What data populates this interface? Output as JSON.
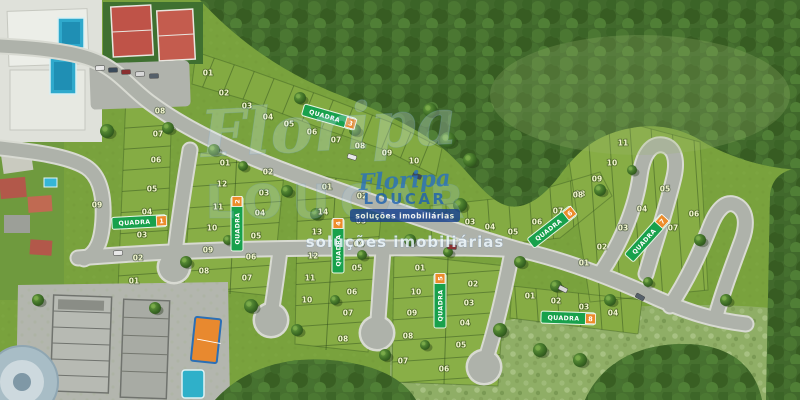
{
  "logo": {
    "name": "Floripa",
    "brand": "LOUCAR",
    "tagline": "soluções imobiliárias"
  },
  "watermark": {
    "script": "Floripa",
    "brand": "LOUCAR",
    "tagline": "soluções imobiliárias"
  },
  "quadra_label_text": "QUADRA",
  "quadras": [
    [
      "1",
      139,
      222,
      -3
    ],
    [
      "2",
      237,
      224,
      -90
    ],
    [
      "3",
      329,
      117,
      16
    ],
    [
      "4",
      338,
      246,
      -90
    ],
    [
      "5",
      440,
      301,
      -90
    ],
    [
      "6",
      552,
      227,
      -38
    ],
    [
      "7",
      647,
      238,
      -48
    ],
    [
      "8",
      568,
      318,
      2
    ]
  ],
  "lots": [
    [
      "01",
      208,
      73
    ],
    [
      "02",
      224,
      93
    ],
    [
      "03",
      247,
      106
    ],
    [
      "04",
      268,
      117
    ],
    [
      "05",
      289,
      124
    ],
    [
      "06",
      312,
      132
    ],
    [
      "07",
      336,
      140
    ],
    [
      "08",
      360,
      146
    ],
    [
      "09",
      387,
      153
    ],
    [
      "10",
      414,
      161
    ],
    [
      "08",
      160,
      111
    ],
    [
      "07",
      158,
      134
    ],
    [
      "06",
      156,
      160
    ],
    [
      "05",
      152,
      189
    ],
    [
      "04",
      147,
      212
    ],
    [
      "03",
      142,
      235
    ],
    [
      "02",
      138,
      258
    ],
    [
      "01",
      134,
      281
    ],
    [
      "09",
      97,
      205
    ],
    [
      "01",
      225,
      163
    ],
    [
      "02",
      268,
      172
    ],
    [
      "12",
      222,
      184
    ],
    [
      "03",
      264,
      193
    ],
    [
      "11",
      218,
      207
    ],
    [
      "04",
      260,
      213
    ],
    [
      "10",
      212,
      228
    ],
    [
      "05",
      256,
      236
    ],
    [
      "09",
      208,
      250
    ],
    [
      "06",
      251,
      257
    ],
    [
      "08",
      204,
      271
    ],
    [
      "07",
      247,
      278
    ],
    [
      "01",
      327,
      187
    ],
    [
      "14",
      323,
      212
    ],
    [
      "13",
      317,
      232
    ],
    [
      "12",
      313,
      256
    ],
    [
      "11",
      310,
      278
    ],
    [
      "10",
      307,
      300
    ],
    [
      "02",
      362,
      196
    ],
    [
      "03",
      361,
      221
    ],
    [
      "04",
      359,
      244
    ],
    [
      "05",
      357,
      268
    ],
    [
      "06",
      352,
      292
    ],
    [
      "07",
      348,
      313
    ],
    [
      "08",
      343,
      339
    ],
    [
      "01",
      420,
      268
    ],
    [
      "10",
      416,
      292
    ],
    [
      "09",
      412,
      313
    ],
    [
      "08",
      408,
      336
    ],
    [
      "07",
      403,
      361
    ],
    [
      "02",
      473,
      284
    ],
    [
      "03",
      469,
      303
    ],
    [
      "04",
      465,
      323
    ],
    [
      "05",
      461,
      345
    ],
    [
      "06",
      444,
      369
    ],
    [
      "02",
      445,
      216
    ],
    [
      "03",
      470,
      222
    ],
    [
      "04",
      490,
      227
    ],
    [
      "05",
      513,
      232
    ],
    [
      "06",
      537,
      222
    ],
    [
      "07",
      558,
      211
    ],
    [
      "08",
      580,
      194
    ],
    [
      "11",
      623,
      143
    ],
    [
      "10",
      612,
      163
    ],
    [
      "09",
      597,
      179
    ],
    [
      "08",
      578,
      195
    ],
    [
      "05",
      665,
      189
    ],
    [
      "04",
      642,
      209
    ],
    [
      "03",
      623,
      228
    ],
    [
      "02",
      602,
      247
    ],
    [
      "01",
      584,
      263
    ],
    [
      "06",
      694,
      214
    ],
    [
      "07",
      673,
      228
    ],
    [
      "01",
      530,
      296
    ],
    [
      "02",
      556,
      301
    ],
    [
      "03",
      584,
      307
    ],
    [
      "04",
      613,
      313
    ]
  ],
  "features": {
    "trees": [
      [
        107,
        131,
        7
      ],
      [
        168,
        128,
        6
      ],
      [
        214,
        150,
        6
      ],
      [
        186,
        262,
        6
      ],
      [
        243,
        166,
        5
      ],
      [
        287,
        191,
        6
      ],
      [
        316,
        214,
        6
      ],
      [
        251,
        306,
        7
      ],
      [
        297,
        330,
        6
      ],
      [
        335,
        300,
        5
      ],
      [
        362,
        255,
        5
      ],
      [
        410,
        240,
        6
      ],
      [
        448,
        252,
        5
      ],
      [
        300,
        98,
        6
      ],
      [
        355,
        130,
        6
      ],
      [
        460,
        205,
        7
      ],
      [
        520,
        262,
        6
      ],
      [
        556,
        286,
        6
      ],
      [
        610,
        300,
        6
      ],
      [
        648,
        282,
        5
      ],
      [
        600,
        190,
        6
      ],
      [
        632,
        170,
        5
      ],
      [
        700,
        240,
        6
      ],
      [
        726,
        300,
        6
      ],
      [
        500,
        330,
        7
      ],
      [
        540,
        350,
        7
      ],
      [
        580,
        360,
        7
      ],
      [
        448,
        140,
        8
      ],
      [
        470,
        160,
        7
      ],
      [
        430,
        110,
        7
      ],
      [
        155,
        308,
        6
      ],
      [
        38,
        300,
        6
      ],
      [
        228,
        240,
        5
      ],
      [
        385,
        355,
        6
      ],
      [
        425,
        345,
        5
      ]
    ],
    "cars": [
      [
        100,
        68,
        -2
      ],
      [
        113,
        70,
        -2
      ],
      [
        126,
        72,
        -2
      ],
      [
        140,
        74,
        -2
      ],
      [
        154,
        76,
        -2
      ],
      [
        352,
        157,
        17
      ],
      [
        417,
        176,
        22
      ],
      [
        452,
        247,
        4
      ],
      [
        563,
        289,
        26
      ],
      [
        640,
        297,
        29
      ],
      [
        118,
        253,
        -3
      ]
    ]
  },
  "colors": {
    "grass": "#79a23d",
    "lot_green": "#85ac44",
    "forest": "#41692c",
    "scrub": "#8fae66",
    "road": "#aeb2aa",
    "road_edge": "#d8dad2",
    "quadra_green": "#18a14c",
    "quadra_orange": "#ec8c2b",
    "pool_blue": "#2fa9cc",
    "court_red": "#bf5348",
    "court_orange": "#e8892f",
    "building_white": "#eceee8",
    "warehouse_gray": "#b7bab3",
    "logo_blue": "#1f63b0",
    "banner_blue": "#17418f"
  }
}
